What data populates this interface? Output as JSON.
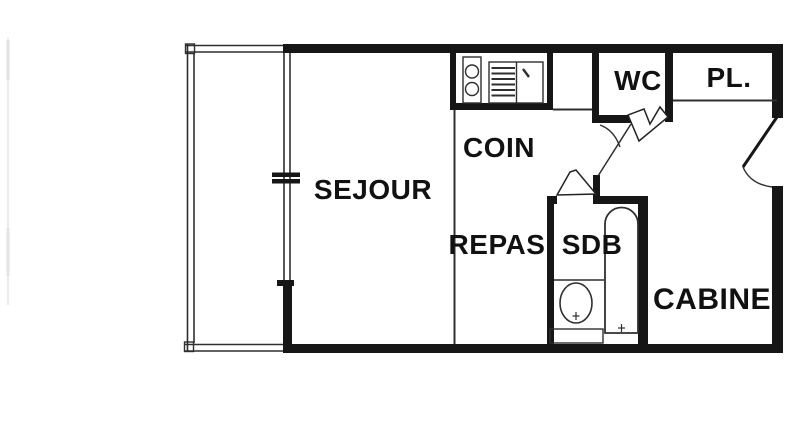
{
  "document": {
    "type": "apartment floor plan",
    "language": "fr"
  },
  "colors": {
    "background": "#ffffff",
    "wall": "#161616",
    "line": "#2f2f2f",
    "text": "#111111"
  },
  "rooms": {
    "sejour": {
      "label": "SEJOUR"
    },
    "coin_repas": {
      "label_line1": "COIN",
      "label_line2": "REPAS"
    },
    "wc": {
      "label": "WC"
    },
    "placard": {
      "label": "PL."
    },
    "sdb": {
      "label": "SDB"
    },
    "cabine": {
      "label": "CABINE"
    }
  },
  "fixtures": {
    "kitchen_sink": "double sink",
    "cooktop": "hatched cooktop",
    "counter": "kitchen counter",
    "washbasin": "washbasin with faucet",
    "bathtub": "bathtub with faucet"
  },
  "doors": [
    "entry-door",
    "wc-door",
    "sdb-door",
    "hallway-door"
  ],
  "windows": [
    "sejour-balcony-window"
  ],
  "outdoor": [
    "balcony"
  ]
}
